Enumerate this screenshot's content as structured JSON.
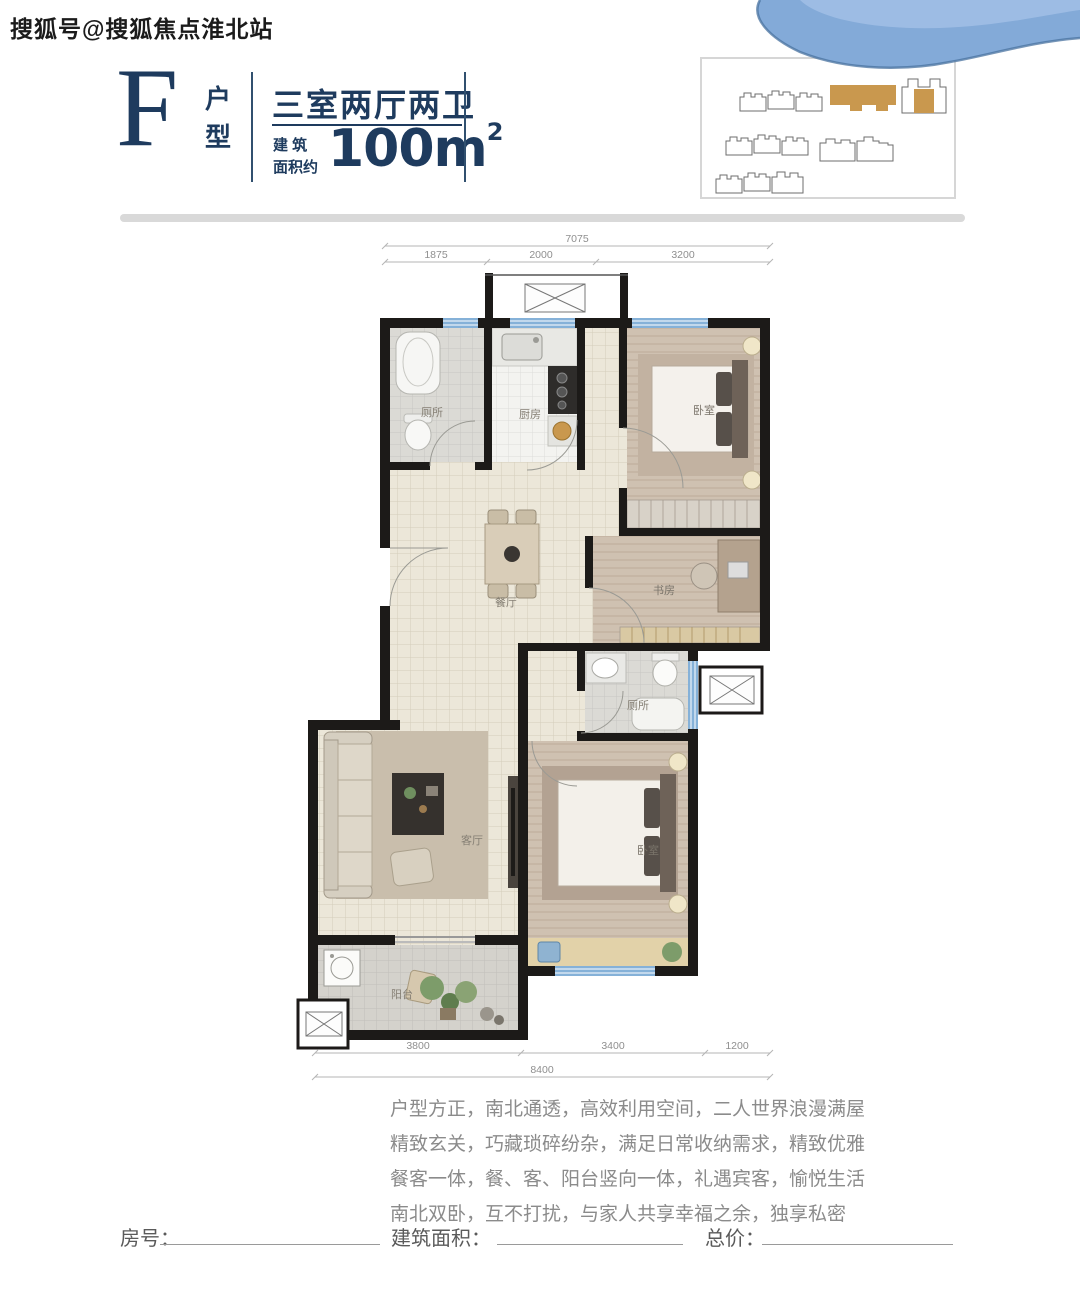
{
  "watermark": "搜狐号@搜狐焦点淮北站",
  "header": {
    "type_letter": "F",
    "type_label_top": "户",
    "type_label_bottom": "型",
    "layout_name": "三室两厅两卫",
    "area_label_row1": "建 筑",
    "area_label_row2": "面积约",
    "area_value": "100m",
    "area_exponent": "2"
  },
  "floor_plan": {
    "rooms": {
      "bathroom1": "厕所",
      "kitchen": "厨房",
      "bedroom1": "卧室",
      "dining": "餐厅",
      "study": "书房",
      "bathroom2": "厕所",
      "living": "客厅",
      "bedroom2": "卧室",
      "balcony": "阳台"
    },
    "dims_top": {
      "total": "7075",
      "seg1": "1875",
      "seg2": "2000",
      "seg3": "3200"
    },
    "dims_bottom": {
      "seg1": "3800",
      "seg2": "3400",
      "seg3": "1200",
      "total": "8400"
    }
  },
  "description": {
    "lines": [
      "户型方正，南北通透，高效利用空间，二人世界浪漫满屋",
      "精致玄关，巧藏琐碎纷杂，满足日常收纳需求，精致优雅",
      "餐客一体，餐、客、阳台竖向一体，礼遇宾客，愉悦生活",
      "南北双卧，互不打扰，与家人共享幸福之余，独享私密"
    ]
  },
  "form": {
    "room_label": "房号：",
    "area_label": "建筑面积：",
    "price_label": "总价："
  },
  "colors": {
    "navy": "#1e3b5e",
    "gold": "#c9984e",
    "window_blue": "#85b1d8",
    "wall_black": "#1c1a18"
  }
}
